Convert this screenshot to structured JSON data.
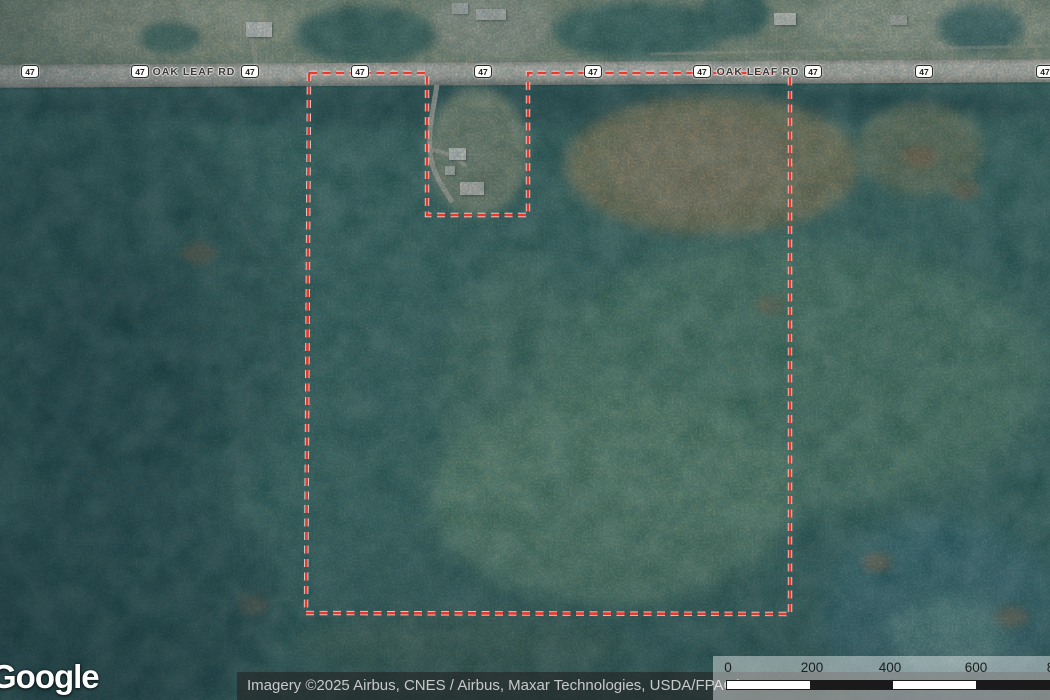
{
  "map": {
    "road_name": "OAK LEAF RD",
    "route_number": "47",
    "shield_positions_x": [
      30,
      140,
      250,
      360,
      483,
      593,
      702,
      813,
      924,
      1045
    ],
    "road_label_positions_x": [
      194,
      758
    ],
    "parcel_boundary": {
      "color": "#e8392d",
      "halo_color": "#ffffff",
      "points": "309,73 427,73 427,215 528,215 528,73 790,73 790,614 306,613"
    }
  },
  "branding": {
    "logo_text": "Google"
  },
  "attribution": {
    "text": "Imagery ©2025 Airbus, CNES / Airbus, Maxar Technologies, USDA/FPAC/GEO"
  },
  "scale_bar": {
    "unit_ticks": [
      {
        "label": "0",
        "x": 728
      },
      {
        "label": "200",
        "x": 812
      },
      {
        "label": "400",
        "x": 890
      },
      {
        "label": "600",
        "x": 976
      },
      {
        "label": "800",
        "x": 1058
      }
    ],
    "bar": {
      "start_x": 727,
      "segment_width": 83,
      "segment_colors": [
        "#ffffff",
        "#1a1a1a",
        "#ffffff",
        "#1a1a1a"
      ]
    }
  }
}
